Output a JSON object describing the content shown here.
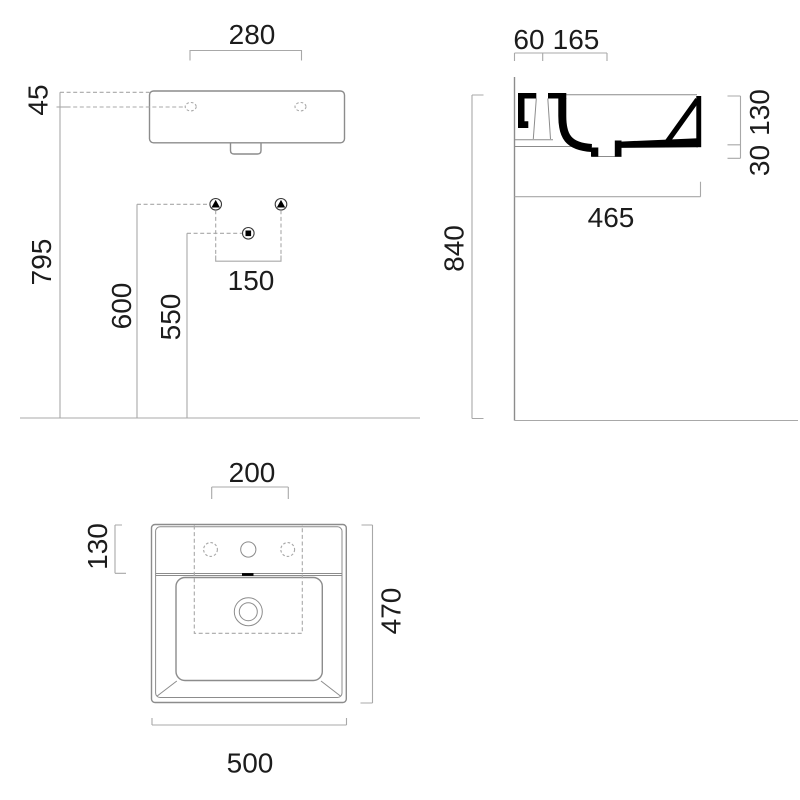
{
  "colors": {
    "line": "#8c8c8c",
    "dim": "#a8a8a8",
    "text": "#1c1c1c",
    "section": "#000000"
  },
  "front_view": {
    "dims": {
      "tap_hole_spacing": "280",
      "rim_to_holes": "45",
      "floor_to_holes": "795",
      "floor_to_brackets": "600",
      "floor_to_drain": "550",
      "bracket_spacing": "150"
    }
  },
  "side_view": {
    "dims": {
      "back_offset": "60",
      "tap_deck_depth": "165",
      "basin_height": "130",
      "apron_height": "30",
      "projection": "465",
      "mounting_height": "840"
    }
  },
  "plan_view": {
    "dims": {
      "tap_template_width": "200",
      "deck_depth": "130",
      "overall_depth": "470",
      "overall_width": "500"
    }
  }
}
